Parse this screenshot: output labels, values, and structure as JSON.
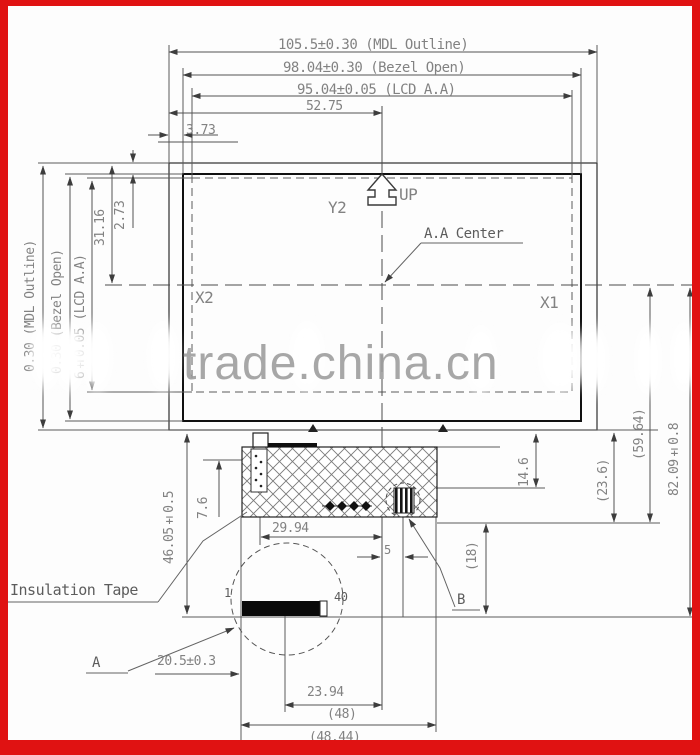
{
  "watermark": "trade.china.cn",
  "dimensions": {
    "top": {
      "mdl_outline": "105.5±0.30 (MDL Outline)",
      "bezel_open": "98.04±0.30 (Bezel Open)",
      "lcd_aa": "95.04±0.05 (LCD A.A)",
      "center_offset": "52.75",
      "edge_offset": "3.73"
    },
    "left": {
      "mdl_outline": "0.30 (MDL Outline)",
      "bezel_open": "0.30 (Bezel Open)",
      "lcd_aa": "6±0.05 (LCD A.A)",
      "top_to_center": "31.16",
      "bezel_gap": "2.73"
    },
    "right": {
      "fpc_height": "14.6",
      "tail_depth": "(23.6)",
      "tail_total": "(59.64)",
      "center_to_pin": "82.09±0.8",
      "connector": "(18)"
    },
    "bottom": {
      "module_to_pin": "46.05±0.5",
      "tape_height": "7.6",
      "fpc_left": "29.94",
      "component_offset": "5",
      "pin_left": "20.5±0.3",
      "pin_row": "23.94",
      "fpc_width": "(48)",
      "fpc_width_total": "(48.44)"
    }
  },
  "labels": {
    "y_axis": "Y2",
    "up": "UP",
    "x_left": "X2",
    "x_right": "X1",
    "aa_center": "A.A Center",
    "insulation_tape": "Insulation Tape",
    "detail_a": "A",
    "detail_b": "B",
    "pin_first": "1",
    "pin_last": "40"
  }
}
